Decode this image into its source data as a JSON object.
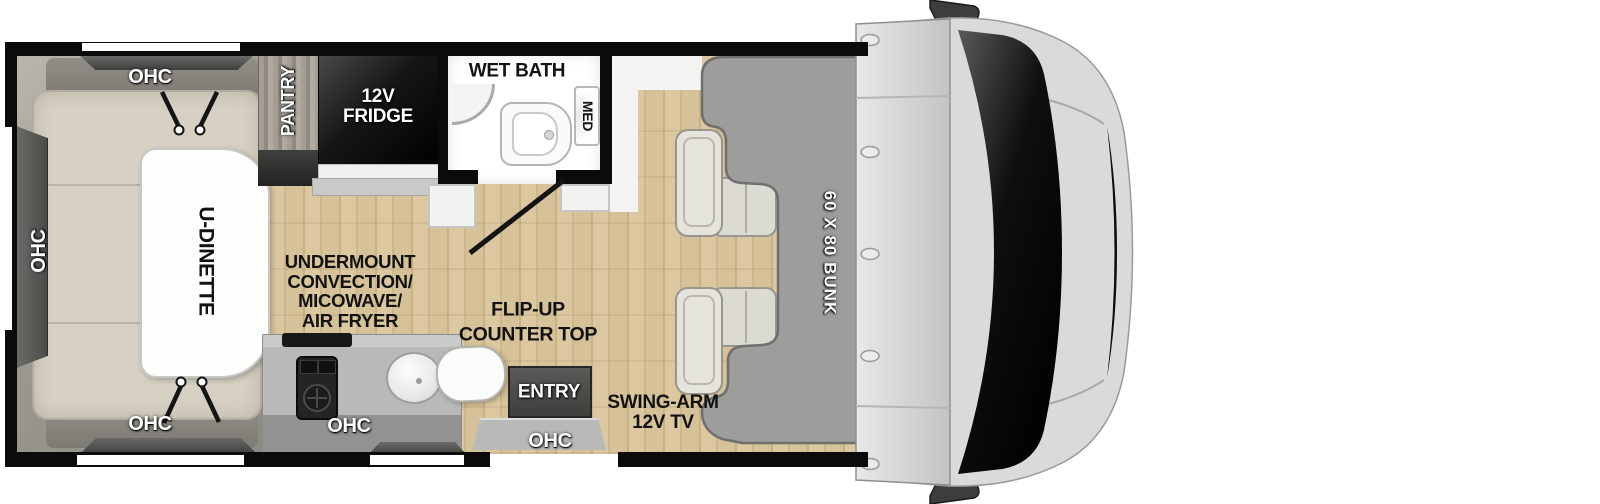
{
  "floorplan": {
    "title": "RV floorplan top view",
    "labels": {
      "ohc_rear_top": "OHC",
      "ohc_rear_side": "OHC",
      "ohc_rear_bottom": "OHC",
      "u_dinette": "U-DINETTE",
      "pantry": "PANTRY",
      "fridge_line1": "12V",
      "fridge_line2": "FRIDGE",
      "wet_bath": "WET BATH",
      "med": "MED",
      "undermount_line1": "UNDERMOUNT",
      "undermount_line2": "CONVECTION/",
      "undermount_line3": "MICOWAVE/",
      "undermount_line4": "AIR FRYER",
      "flip_up_line1": "FLIP-UP",
      "flip_up_line2": "COUNTER TOP",
      "ohc_kitchen": "OHC",
      "entry": "ENTRY",
      "ohc_entry": "OHC",
      "tv_line1": "SWING-ARM",
      "tv_line2": "12V TV",
      "bunk": "60 X 80 BUNK"
    },
    "colors": {
      "wall": "#0b0b0b",
      "wood_floor": "#d6c298",
      "bunk_gray": "#9d9d9b",
      "cushion_beige": "#d6d1c3",
      "counter_gray": "#b9b9b7",
      "entry_dark": "#4e4e4c",
      "fridge_black": "#0d0d0d",
      "cab_body": "#dadada",
      "windshield": "#000000",
      "label_white": "#ffffff",
      "label_black": "#121212"
    }
  }
}
